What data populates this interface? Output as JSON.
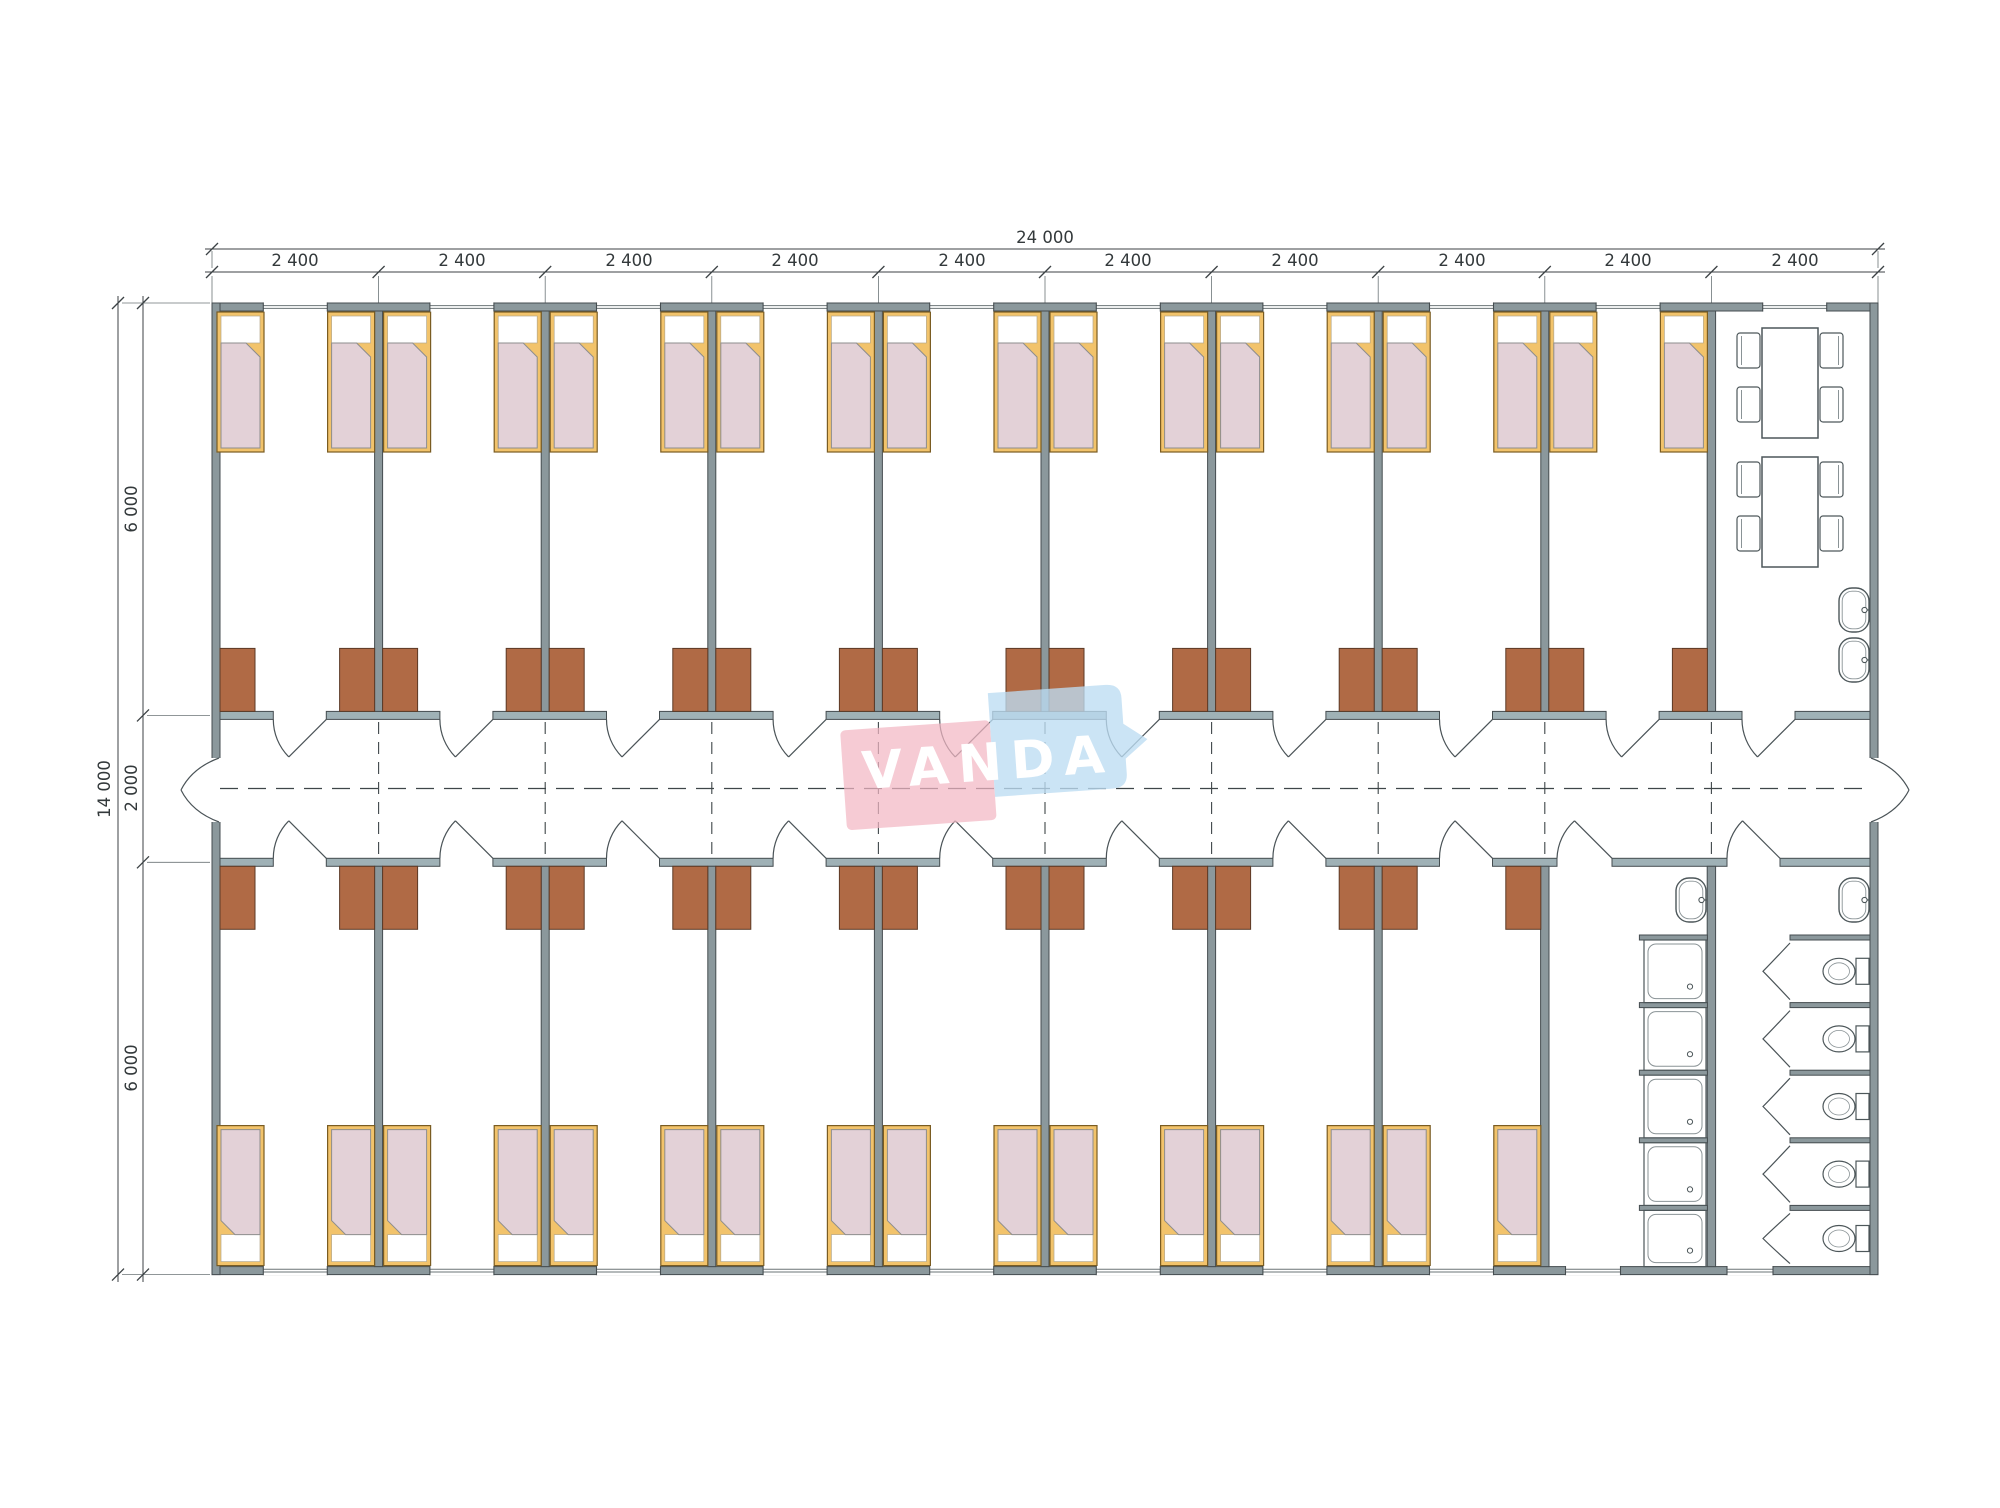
{
  "watermark": {
    "text": "VANDA",
    "pink": "#f3b7c3",
    "blue": "#bddcf2",
    "text_color": "#ffffff"
  },
  "dimensions": {
    "total_width": "24 000",
    "module_width": "2 400",
    "module_count": 10,
    "total_height": "14 000",
    "section_top": "6 000",
    "section_corridor": "2 000",
    "section_bottom": "6 000"
  },
  "plan_summary": {
    "bedrooms_top_row": 9,
    "bedrooms_bottom_row": 8,
    "beds_total": 34,
    "wardrobes_total": 34,
    "dining_room": {
      "tables": 2,
      "chairs": 8,
      "sinks": 2
    },
    "washroom": {
      "showers": 5,
      "sinks": 1
    },
    "wc_room": {
      "toilets": 5,
      "sinks": 1
    },
    "corridor_doors": 2
  },
  "colors": {
    "wall": "#8b989c",
    "corridor_wall": "#9fb1b6",
    "wall_stroke": "#454d50",
    "bed_frame": "#f2c36b",
    "bed_frame_stroke": "#7a5c22",
    "bedding": "#e3d1d7",
    "bedding_stroke": "#8d8d8d",
    "pillow": "#ffffff",
    "wardrobe": "#b06a45",
    "wardrobe_stroke": "#5c3a26",
    "fixture_stroke": "#4d575a",
    "fixture_inner": "#8a9396",
    "door_line": "#4a5357",
    "dash_line": "#3f4649",
    "dim_line": "#3c4245",
    "window_line": "#6b7477"
  }
}
